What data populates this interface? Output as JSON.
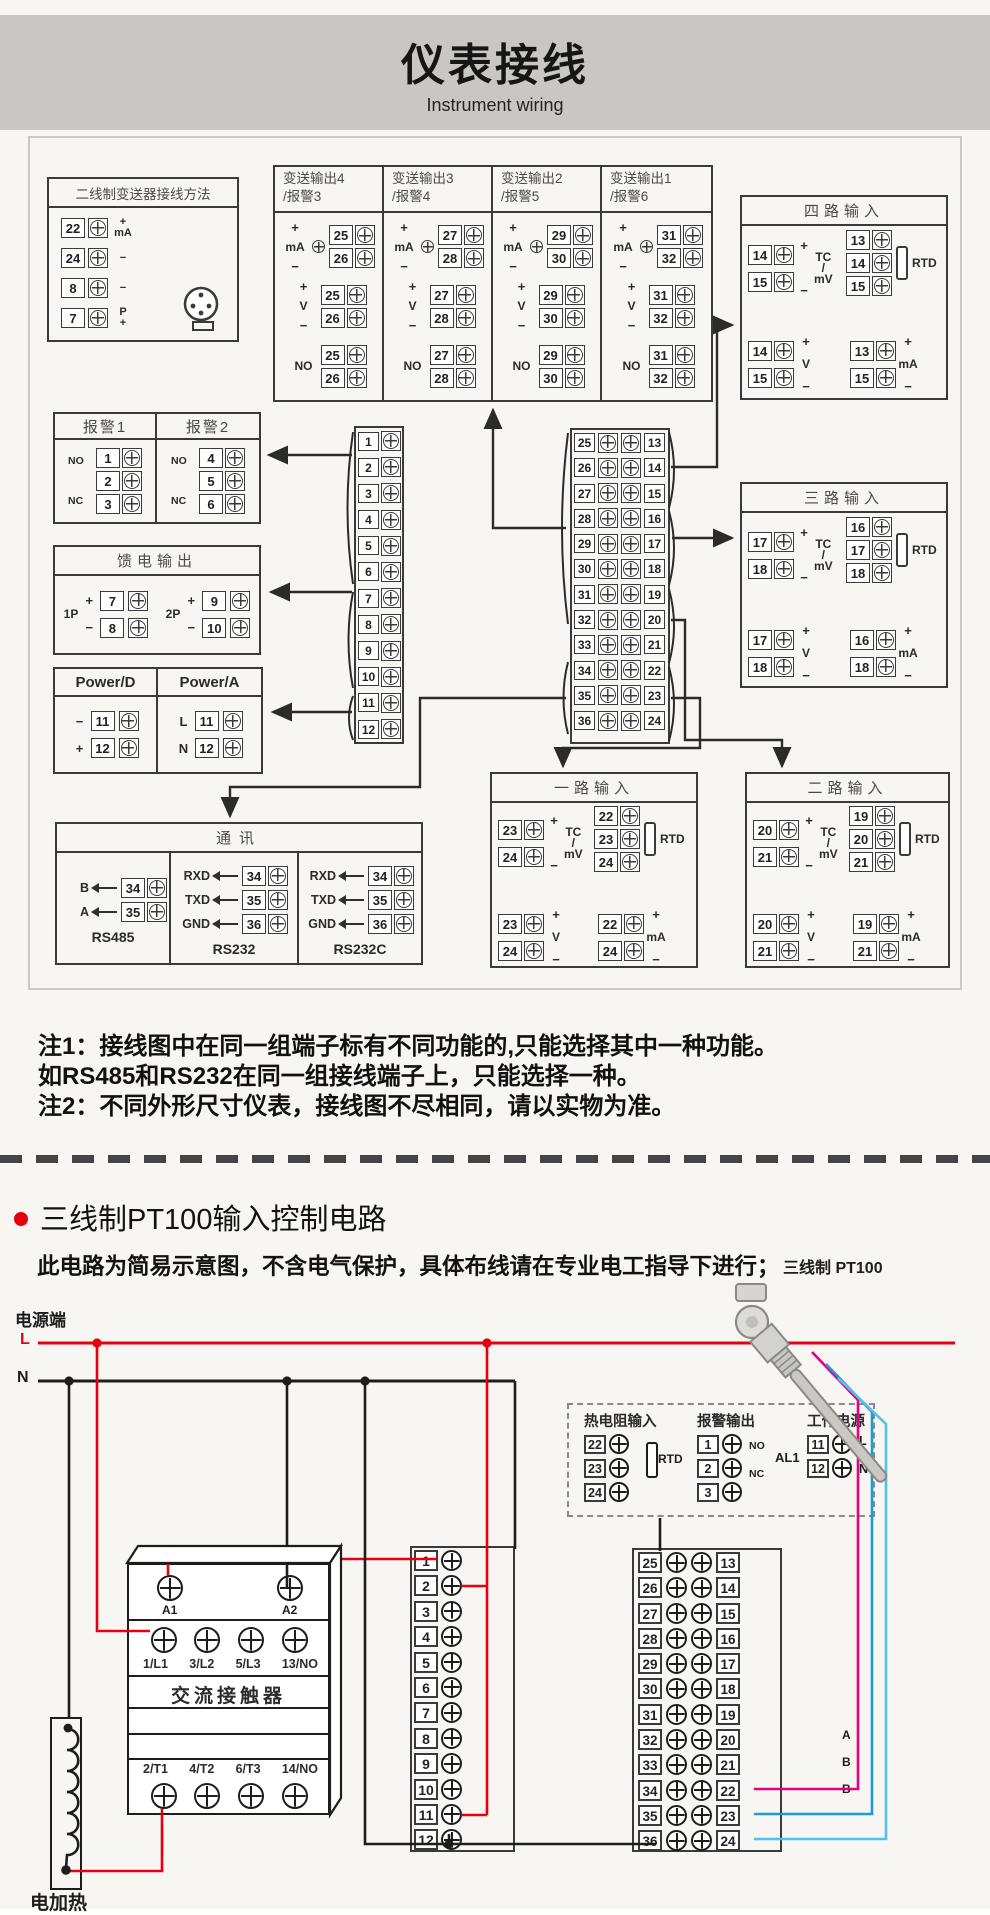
{
  "page": {
    "title": "仪表接线",
    "subtitle": "Instrument wiring"
  },
  "two_wire": {
    "title": "二线制变送器接线方法",
    "rows": [
      {
        "n": "22",
        "s1": "+",
        "s2": "mA"
      },
      {
        "n": "24",
        "s1": "−",
        "s2": ""
      },
      {
        "n": "8",
        "s1": "−",
        "s2": ""
      },
      {
        "n": "7",
        "s1": "P",
        "s2": "+"
      }
    ]
  },
  "tx": {
    "plus": "+",
    "minus": "−",
    "ma": "mA",
    "v": "V",
    "no": "NO",
    "cols": [
      {
        "t1": "变送输出4",
        "t2": "/报警3",
        "a": "25",
        "b": "26"
      },
      {
        "t1": "变送输出3",
        "t2": "/报警4",
        "a": "27",
        "b": "28"
      },
      {
        "t1": "变送输出2",
        "t2": "/报警5",
        "a": "29",
        "b": "30"
      },
      {
        "t1": "变送输出1",
        "t2": "/报警6",
        "a": "31",
        "b": "32"
      }
    ]
  },
  "io": {
    "labels": {
      "tc": "TC",
      "slash": "/",
      "mv": "mV",
      "rtd": "RTD",
      "v": "V",
      "ma": "mA",
      "plus": "+",
      "minus": "−"
    },
    "four": {
      "title": "四路输入",
      "tc_a": "14",
      "tc_b": "15",
      "rtd_a": "13",
      "rtd_b": "14",
      "rtd_c": "15",
      "v_a": "14",
      "v_b": "15",
      "ma_a": "13",
      "ma_b": "15"
    },
    "three": {
      "title": "三路输入",
      "tc_a": "17",
      "tc_b": "18",
      "rtd_a": "16",
      "rtd_b": "17",
      "rtd_c": "18",
      "v_a": "17",
      "v_b": "18",
      "ma_a": "16",
      "ma_b": "18"
    },
    "one": {
      "title": "一路输入",
      "tc_a": "23",
      "tc_b": "24",
      "rtd_a": "22",
      "rtd_b": "23",
      "rtd_c": "24",
      "v_a": "23",
      "v_b": "24",
      "ma_a": "22",
      "ma_b": "24"
    },
    "two": {
      "title": "二路输入",
      "tc_a": "20",
      "tc_b": "21",
      "rtd_a": "19",
      "rtd_b": "20",
      "rtd_c": "21",
      "v_a": "20",
      "v_b": "21",
      "ma_a": "19",
      "ma_b": "21"
    }
  },
  "alarm": {
    "t1": "报警1",
    "t2": "报警2",
    "no": "NO",
    "nc": "NC",
    "g1": [
      "1",
      "2",
      "3"
    ],
    "g2": [
      "4",
      "5",
      "6"
    ]
  },
  "feed": {
    "title": "馈电输出",
    "g1": "1P",
    "g2": "2P",
    "rows1": [
      {
        "n": "7",
        "s": "+"
      },
      {
        "n": "8",
        "s": "−"
      }
    ],
    "rows2": [
      {
        "n": "9",
        "s": "+"
      },
      {
        "n": "10",
        "s": "−"
      }
    ]
  },
  "power": {
    "t1": "Power/D",
    "t2": "Power/A",
    "d": [
      {
        "n": "11",
        "s": "−"
      },
      {
        "n": "12",
        "s": "+"
      }
    ],
    "a": [
      {
        "n": "11",
        "s": "L"
      },
      {
        "n": "12",
        "s": "N"
      }
    ]
  },
  "comm": {
    "title": "通讯",
    "s1": {
      "cap": "RS485",
      "rows": [
        {
          "l": "B",
          "n": "34"
        },
        {
          "l": "A",
          "n": "35"
        }
      ]
    },
    "s2": {
      "cap": "RS232",
      "rows": [
        {
          "l": "RXD",
          "n": "34"
        },
        {
          "l": "TXD",
          "n": "35"
        },
        {
          "l": "GND",
          "n": "36"
        }
      ]
    },
    "s3": {
      "cap": "RS232C",
      "rows": [
        {
          "l": "RXD",
          "n": "34"
        },
        {
          "l": "TXD",
          "n": "35"
        },
        {
          "l": "GND",
          "n": "36"
        }
      ]
    }
  },
  "strips": {
    "left": [
      "1",
      "2",
      "3",
      "4",
      "5",
      "6",
      "7",
      "8",
      "9",
      "10",
      "11",
      "12"
    ],
    "right": [
      {
        "l": "25",
        "r": "13"
      },
      {
        "l": "26",
        "r": "14"
      },
      {
        "l": "27",
        "r": "15"
      },
      {
        "l": "28",
        "r": "16"
      },
      {
        "l": "29",
        "r": "17"
      },
      {
        "l": "30",
        "r": "18"
      },
      {
        "l": "31",
        "r": "19"
      },
      {
        "l": "32",
        "r": "20"
      },
      {
        "l": "33",
        "r": "21"
      },
      {
        "l": "34",
        "r": "22"
      },
      {
        "l": "35",
        "r": "23"
      },
      {
        "l": "36",
        "r": "24"
      }
    ],
    "mid2": [
      "1",
      "2",
      "3",
      "4",
      "5",
      "6",
      "7",
      "8",
      "9",
      "10",
      "11",
      "12"
    ],
    "right2": [
      {
        "l": "25",
        "r": "13"
      },
      {
        "l": "26",
        "r": "14"
      },
      {
        "l": "27",
        "r": "15"
      },
      {
        "l": "28",
        "r": "16"
      },
      {
        "l": "29",
        "r": "17"
      },
      {
        "l": "30",
        "r": "18"
      },
      {
        "l": "31",
        "r": "19"
      },
      {
        "l": "32",
        "r": "20"
      },
      {
        "l": "33",
        "r": "21"
      },
      {
        "l": "34",
        "r": "22"
      },
      {
        "l": "35",
        "r": "23"
      },
      {
        "l": "36",
        "r": "24"
      }
    ]
  },
  "notes": {
    "l1": "注1：接线图中在同一组端子标有不同功能的,只能选择其中一种功能。",
    "l2": "如RS485和RS232在同一组接线端子上，只能选择一种。",
    "l3": "注2：不同外形尺寸仪表，接线图不尽相同，请以实物为准。"
  },
  "sec2": {
    "heading": "三线制PT100输入控制电路",
    "sub": "此电路为简易示意图，不含电气保护，具体布线请在专业电工指导下进行；",
    "power_end": "电源端",
    "l": "L",
    "n": "N",
    "pt100": "三线制 PT100",
    "heater": "电加热",
    "wire_a": "A",
    "wire_b1": "B",
    "wire_b2": "B",
    "colors": {
      "live": "#e60012",
      "neutral": "#1d1d1b",
      "wire_a": "#e4007f",
      "wire_b": "#1d9bd7",
      "wire_b2": "#4fc3e8"
    }
  },
  "dashed": {
    "rtd": {
      "title": "热电阻输入",
      "terms": [
        "22",
        "23",
        "24"
      ],
      "lbl": "RTD"
    },
    "alarm": {
      "title": "报警输出",
      "terms": [
        "1",
        "2",
        "3"
      ],
      "no": "NO",
      "nc": "NC",
      "al1": "AL1"
    },
    "power": {
      "title": "工作电源",
      "terms": [
        "11",
        "12"
      ],
      "l": "L",
      "n": "N"
    }
  },
  "contactor": {
    "title": "交流接触器",
    "a1": "A1",
    "a2": "A2",
    "top": [
      "1/L1",
      "3/L2",
      "5/L3",
      "13/NO"
    ],
    "bottom": [
      "2/T1",
      "4/T2",
      "6/T3",
      "14/NO"
    ]
  }
}
